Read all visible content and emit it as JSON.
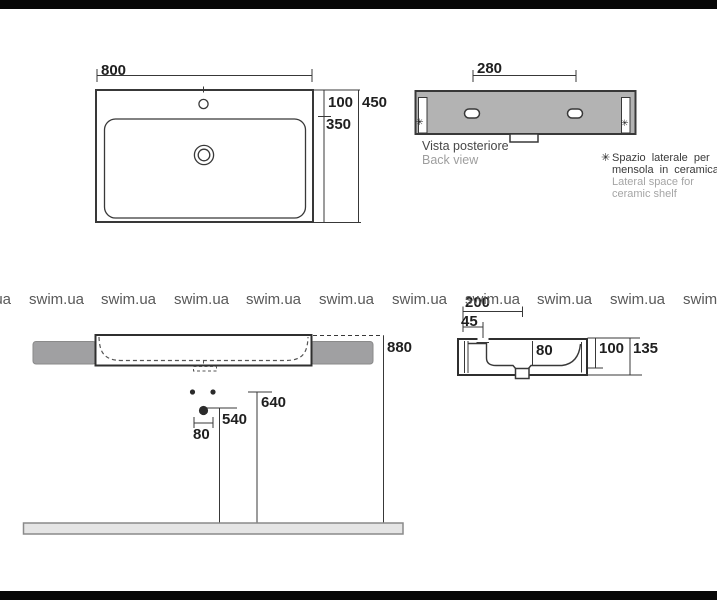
{
  "watermark": {
    "text": "swim.ua"
  },
  "top_view": {
    "dim_width": "800",
    "dim_back_offset": "100",
    "dim_total_depth": "450",
    "dim_front_depth": "350"
  },
  "back_view": {
    "dim_hole_spacing": "280",
    "caption_it": "Vista posteriore",
    "caption_en": "Back view",
    "slot_marker": "✳"
  },
  "note": {
    "marker": "✳",
    "line1_it": "Spazio laterale per",
    "line2_it": "mensola in ceramica",
    "line1_en": "Lateral space for",
    "line2_en": "ceramic shelf"
  },
  "front_view": {
    "dim_height": "880",
    "dim_upper_holes": "640",
    "dim_lower_hole": "540",
    "dim_hole_gap": "80"
  },
  "side_view": {
    "dim_drain_offset": "200",
    "dim_faucet_offset": "45",
    "dim_inner": "80",
    "dim_basin_depth": "100",
    "dim_total_depth": "135"
  },
  "colors": {
    "line": "#383838",
    "back_view_fill": "#b3b3b3",
    "side_bar_fill": "#a0a0a2",
    "floor_fill": "#e5e5e5",
    "letterbox": "#070707",
    "watermark_text": "#595959"
  }
}
